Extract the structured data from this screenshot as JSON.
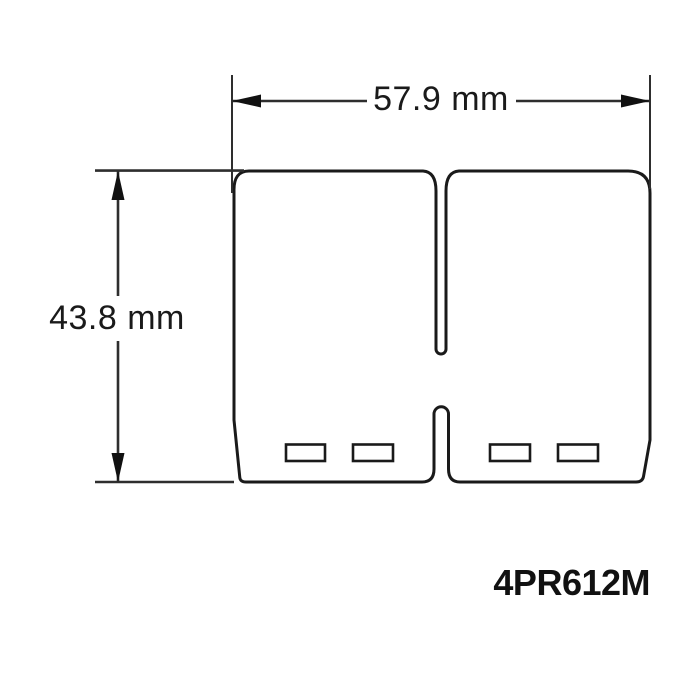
{
  "drawing": {
    "part_number": "4PR612M",
    "width_dimension": {
      "label": "57.9 mm",
      "value_mm": 57.9
    },
    "height_dimension": {
      "label": "43.8 mm",
      "value_mm": 43.8
    },
    "colors": {
      "ink": "#1a1a1a",
      "dimension_line": "#2e2e2e",
      "background": "#ffffff"
    }
  }
}
